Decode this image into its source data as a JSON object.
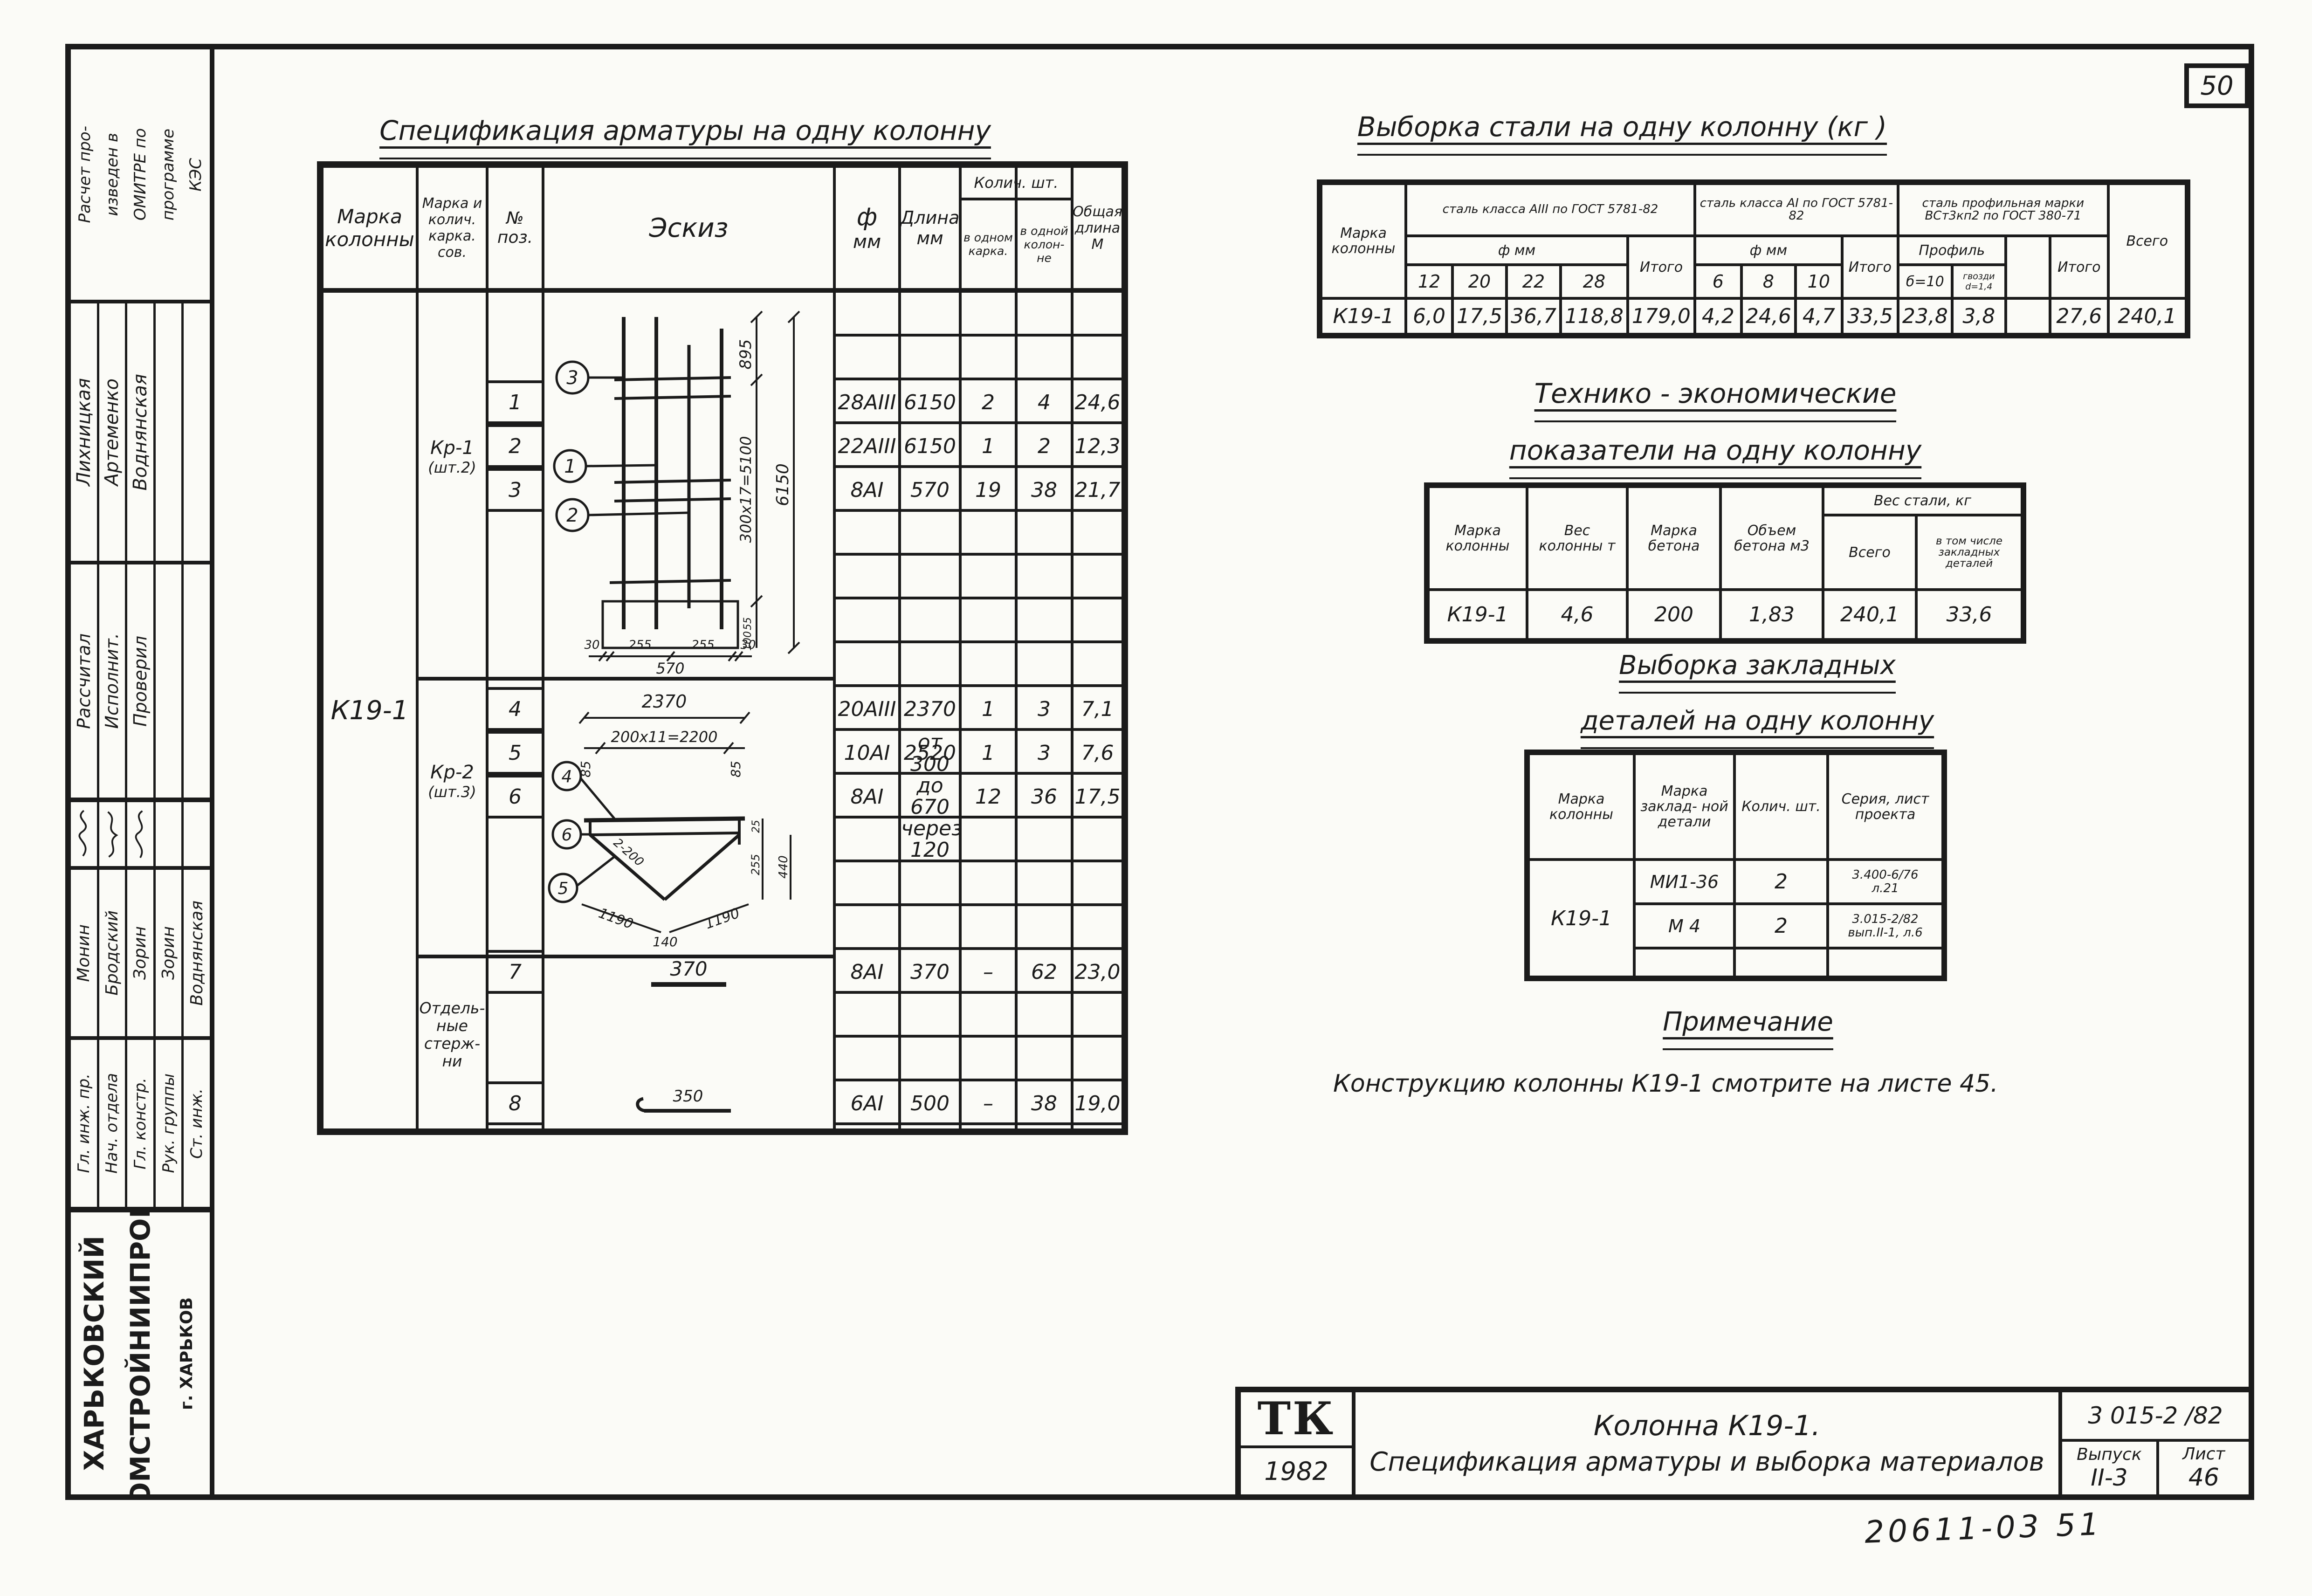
{
  "sheet": {
    "page_number": "50",
    "archive_note": "20611-03  51"
  },
  "sidebar": {
    "program_note_lines": [
      "Расчет про-",
      "изведен в",
      "ОМИТРЕ по",
      "программе",
      "КЭС"
    ],
    "stamp_top": {
      "roles": [
        "Рассчитал",
        "Исполнит.",
        "Проверил"
      ],
      "names": [
        "Лихницкая",
        "Артеменко",
        "Воднянская"
      ]
    },
    "stamp_bottom": {
      "roles": [
        "Гл. инж. пр.",
        "Нач. отдела",
        "Гл. констр.",
        "Рук. группы",
        "Ст. инж."
      ],
      "names": [
        "Монин",
        "Бродский",
        "Зорин",
        "Зорин",
        "Воднянская"
      ]
    },
    "organization_line1": "ХАРЬКОВСКИЙ",
    "organization_line2": "ПРОМСТРОЙНИИПРОЕКТ",
    "organization_city": "г. ХАРЬКОВ"
  },
  "spec_table": {
    "title": "Спецификация арматуры на одну колонну",
    "headers": {
      "mark": "Марка колонны",
      "frame": "Марка и колич. карка. сов.",
      "pos": "№ поз.",
      "sketch": "Эскиз",
      "dia": "ф",
      "dia_unit": "мм",
      "len": "Длина",
      "len_unit": "мм",
      "qty": "Колич. шт.",
      "qty_frame": "в одном карка.",
      "qty_col": "в одной колон-не",
      "total": "Общая длина М"
    },
    "column_mark": "К19-1",
    "groups": [
      {
        "name": "Кр-1",
        "qty": "(шт.2)"
      },
      {
        "name": "Кр-2",
        "qty": "(шт.3)"
      },
      {
        "l1": "Отдель-",
        "l2": "ные",
        "l3": "стерж-",
        "l4": "ни"
      }
    ],
    "rows": [
      {
        "pos": "1",
        "dia": "28АIII",
        "len": "6150",
        "in_frame": "2",
        "in_col": "4",
        "total_len": "24,6"
      },
      {
        "pos": "2",
        "dia": "22АIII",
        "len": "6150",
        "in_frame": "1",
        "in_col": "2",
        "total_len": "12,3"
      },
      {
        "pos": "3",
        "dia": "8АI",
        "len": "570",
        "in_frame": "19",
        "in_col": "38",
        "total_len": "21,7"
      },
      {
        "pos": "4",
        "dia": "20АIII",
        "len": "2370",
        "in_frame": "1",
        "in_col": "3",
        "total_len": "7,1"
      },
      {
        "pos": "5",
        "dia": "10АI",
        "len": "2520",
        "in_frame": "1",
        "in_col": "3",
        "total_len": "7,6"
      },
      {
        "pos": "6",
        "dia": "8АI",
        "len": "от 300",
        "len2": "до 670",
        "len3": "через 120",
        "in_frame": "12",
        "in_col": "36",
        "total_len": "17,5"
      },
      {
        "pos": "7",
        "dia": "8АI",
        "len": "370",
        "in_frame": "–",
        "in_col": "62",
        "total_len": "23,0"
      },
      {
        "pos": "8",
        "dia": "6АI",
        "len": "500",
        "in_frame": "–",
        "in_col": "38",
        "total_len": "19,0"
      }
    ],
    "sketch_kr1": {
      "callout_top": "3",
      "callout_mid": "1",
      "callout_bot": "2",
      "dim_895": "895",
      "dim_step": "300x17=5100",
      "dim_total": "6150",
      "dim_55": "55",
      "dim_100": "100",
      "dim_30a": "30",
      "dim_255a": "255",
      "dim_255b": "255",
      "dim_30b": "30",
      "dim_570": "570"
    },
    "sketch_kr2": {
      "callout_top": "4",
      "callout_mid": "6",
      "callout_bot": "5",
      "dim_top": "2370",
      "dim_85a": "85",
      "dim_step": "200x11=2200",
      "dim_85b": "85",
      "dim_25": "25",
      "dim_255": "255",
      "dim_440": "440",
      "dim_diag": "2-200",
      "dim_left": "1190",
      "dim_mid": "140",
      "dim_right": "1190"
    },
    "sketch_row7": "370",
    "sketch_row8": "350"
  },
  "steel_table": {
    "title": "Выборка стали на одну колонну  (кг )",
    "mark_header": "Марка колонны",
    "group1": "сталь класса АIII по ГОСТ 5781-82",
    "group2": "сталь класса АI по ГОСТ 5781-82",
    "group3": "сталь профильная марки ВСт3кп2 по ГОСТ 380-71",
    "sub1": "ф мм",
    "sub2": "ф мм",
    "sub3": "Профиль",
    "itogo1": "Итого",
    "itogo2": "Итого",
    "itogo3": "Итого",
    "vsego": "Всего",
    "dias1": [
      "12",
      "20",
      "22",
      "28"
    ],
    "dias2": [
      "6",
      "8",
      "10"
    ],
    "profiles": [
      "б=10",
      "гвозди d=1,4"
    ],
    "row": {
      "mark": "К19-1",
      "values": [
        "6,0",
        "17,5",
        "36,7",
        "118,8",
        "179,0",
        "4,2",
        "24,6",
        "4,7",
        "33,5",
        "23,8",
        "3,8",
        "",
        "27,6",
        "240,1"
      ]
    }
  },
  "tech_table": {
    "title_line1": "Технико - экономические",
    "title_line2": "показатели на одну колонну",
    "h_mark": "Марка колонны",
    "h_weight": "Вес колонны т",
    "h_grade": "Марка бетона",
    "h_volume": "Объем бетона м3",
    "h_steel": "Вес стали, кг",
    "h_steel_total": "Всего",
    "h_steel_embed": "в том числе закладных деталей",
    "row": {
      "mark": "К19-1",
      "weight": "4,6",
      "grade": "200",
      "volume": "1,83",
      "steel_total": "240,1",
      "steel_embed": "33,6"
    }
  },
  "embed_table": {
    "title_line1": "Выборка закладных",
    "title_line2": "деталей на одну колонну",
    "h_mark": "Марка колонны",
    "h_detail": "Марка заклад- ной детали",
    "h_qty": "Колич. шт.",
    "h_series": "Серия, лист проекта",
    "mark": "К19-1",
    "rows": [
      {
        "detail": "МИ1-36",
        "qty": "2",
        "series1": "3.400-6/76",
        "series2": "л.21"
      },
      {
        "detail": "М 4",
        "qty": "2",
        "series1": "3.015-2/82",
        "series2": "вып.II-1, л.6"
      }
    ]
  },
  "note": {
    "title": "Примечание",
    "text": "Конструкцию колонны  К19-1  смотрите на листе 45."
  },
  "title_block": {
    "logo": "ТК",
    "year": "1982",
    "line1": "Колонна    К19-1.",
    "line2": "Спецификация арматуры и выборка материалов",
    "doc_number": "3 015-2 /82",
    "issue_label": "Выпуск",
    "issue": "II-3",
    "sheet_label": "Лист",
    "sheet": "46"
  }
}
